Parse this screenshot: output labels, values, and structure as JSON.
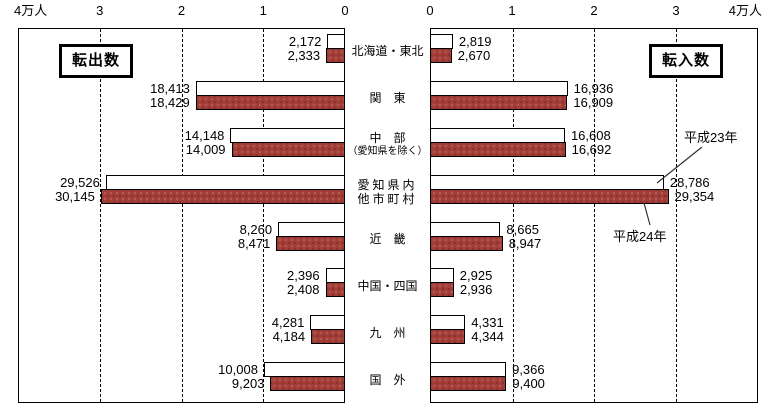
{
  "legend": {
    "out": "転出数",
    "in": "転入数"
  },
  "annotations": {
    "h23": "平成23年",
    "h24": "平成24年"
  },
  "colors": {
    "h23_bar": "#ffffff",
    "h24_bar": "#a33d38",
    "h24_dot_dark": "#7e2b28",
    "h24_dot_light": "#bc6a60",
    "border": "#000000"
  },
  "chart_data": {
    "type": "bar",
    "subtype": "horizontal paired bidirectional (tornado)",
    "unit": "人",
    "axis_max": 40000,
    "ticks_left": [
      "4万人",
      "3",
      "2",
      "1",
      "0"
    ],
    "ticks_right": [
      "0",
      "1",
      "2",
      "3",
      "4万人"
    ],
    "left_panel_title": "転出数",
    "right_panel_title": "転入数",
    "grid": "dashed vertical at 1万人 intervals",
    "categories": [
      "北海道・東北",
      "関東",
      "中部（愛知県を除く）",
      "愛知県内他市町村",
      "近畿",
      "中国・四国",
      "九州",
      "国外"
    ],
    "category_display": [
      [
        "北海道・東北"
      ],
      [
        "関　東"
      ],
      [
        "中　部",
        "（愛知県を除く）"
      ],
      [
        "愛知県内",
        "他市町村"
      ],
      [
        "近　畿"
      ],
      [
        "中国・四国"
      ],
      [
        "九　州"
      ],
      [
        "国　外"
      ]
    ],
    "series": [
      {
        "name": "平成23年",
        "out_values": [
          2172,
          18413,
          14148,
          29526,
          8260,
          2396,
          4281,
          10008
        ],
        "in_values": [
          2819,
          16936,
          16608,
          28786,
          8665,
          2925,
          4331,
          9366
        ]
      },
      {
        "name": "平成24年",
        "out_values": [
          2333,
          18429,
          14009,
          30145,
          8471,
          2408,
          4184,
          9203
        ],
        "in_values": [
          2670,
          16909,
          16692,
          29354,
          8947,
          2936,
          4344,
          9400
        ]
      }
    ]
  }
}
